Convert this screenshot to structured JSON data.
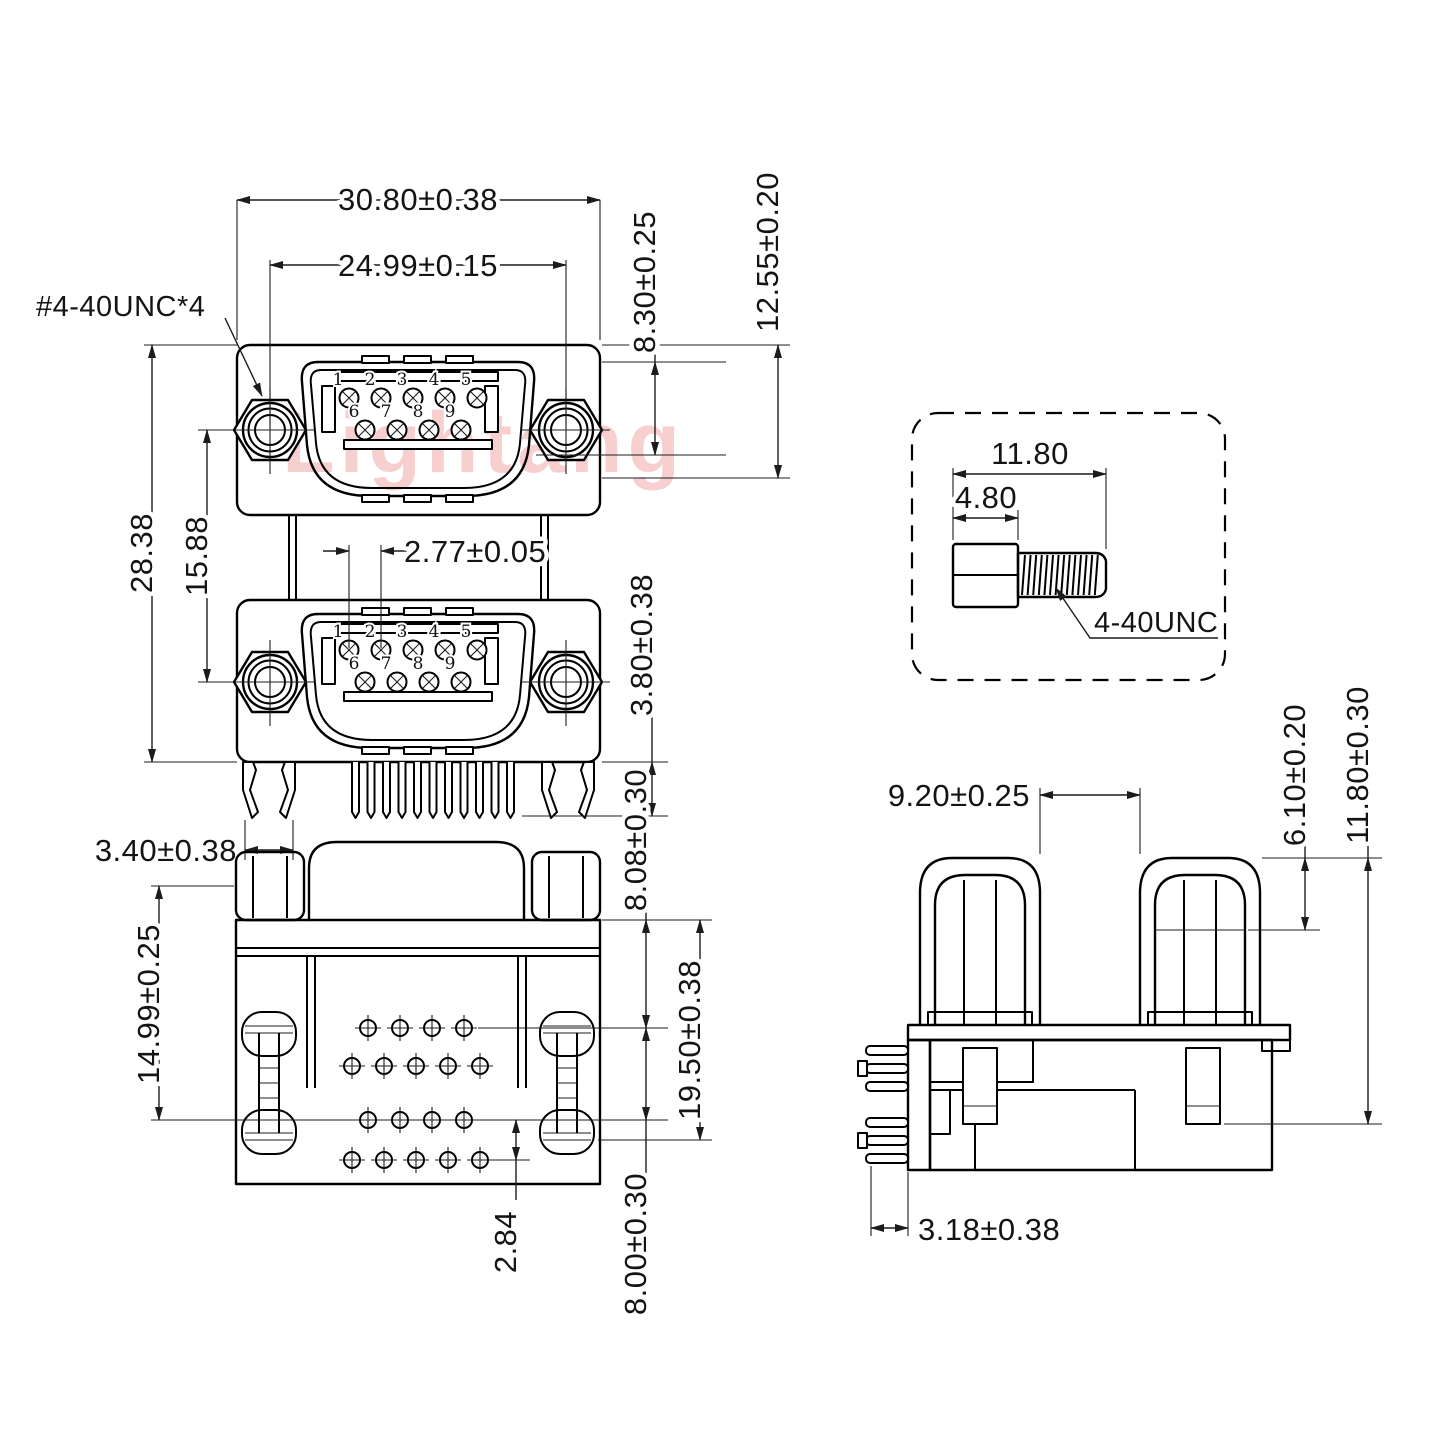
{
  "watermark": "Lightang",
  "front_view": {
    "dims": {
      "housing_width": "30.80±0.38",
      "screw_spacing": "24.99±0.15",
      "thread_callout": "#4-40UNC*4",
      "shell_height": "8.30±0.25",
      "housing_height": "12.55±0.20",
      "total_height": "28.38",
      "port_spacing": "15.88",
      "pin_pitch": "2.77±0.05",
      "pin_length": "3.80±0.38",
      "boardlock_width": "3.40±0.38"
    },
    "upper_port": {
      "pin_numbers_row1": [
        "1",
        "2",
        "3",
        "4",
        "5"
      ],
      "pin_numbers_row2": [
        "6",
        "7",
        "8",
        "9"
      ]
    },
    "lower_port": {
      "pin_numbers_row1": [
        "1",
        "2",
        "3",
        "4",
        "5"
      ],
      "pin_numbers_row2": [
        "6",
        "7",
        "8",
        "9"
      ]
    }
  },
  "screw_detail": {
    "dims": {
      "total_length": "11.80",
      "head_length": "4.80",
      "thread_callout": "4-40UNC"
    }
  },
  "bottom_view": {
    "dims": {
      "boardlock_offset": "14.99±0.25",
      "first_row_offset": "8.08±0.30",
      "last_row_offset": "19.50±0.38",
      "row_pitch": "2.84",
      "group_pitch": "8.00±0.30"
    }
  },
  "side_view": {
    "dims": {
      "nut_gap": "9.20±0.25",
      "nut_height": "6.10±0.20",
      "screw_length": "11.80±0.30",
      "pin_offset": "3.18±0.38"
    }
  }
}
